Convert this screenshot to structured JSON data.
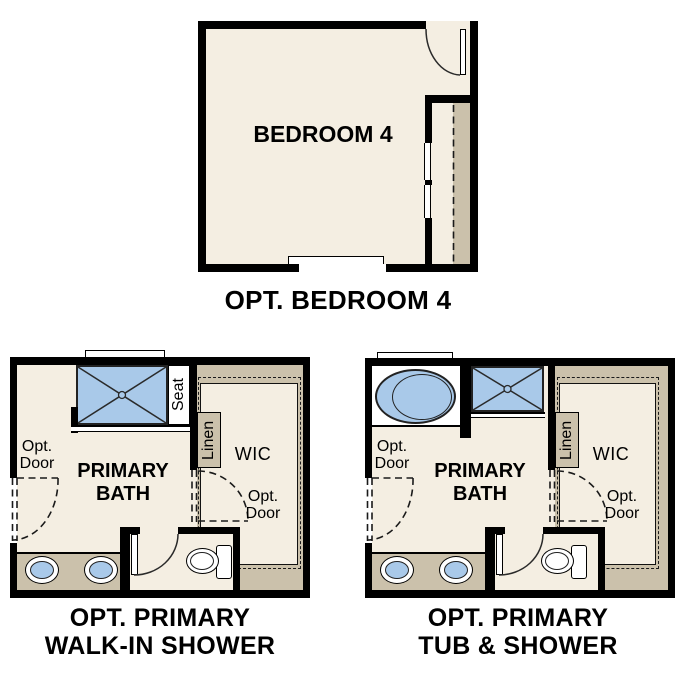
{
  "colors": {
    "wall": "#000000",
    "floor": "#f4eee2",
    "closet_tan": "#cbc1ab",
    "fixture_blue": "#a9c9e9",
    "background": "#ffffff"
  },
  "bedroom_plan": {
    "room_label": "BEDROOM 4",
    "caption": "OPT. BEDROOM 4"
  },
  "walk_in_shower_plan": {
    "room_label_line1": "PRIMARY",
    "room_label_line2": "BATH",
    "seat_label": "Seat",
    "linen_label": "Linen",
    "wic_label": "WIC",
    "opt_door_left_line1": "Opt.",
    "opt_door_left_line2": "Door",
    "opt_door_mid_line1": "Opt.",
    "opt_door_mid_line2": "Door",
    "caption_line1": "OPT. PRIMARY",
    "caption_line2": "WALK-IN SHOWER"
  },
  "tub_shower_plan": {
    "room_label_line1": "PRIMARY",
    "room_label_line2": "BATH",
    "seat_label": "Seat",
    "linen_label": "Linen",
    "wic_label": "WIC",
    "opt_door_left_line1": "Opt.",
    "opt_door_left_line2": "Door",
    "opt_door_mid_line1": "Opt.",
    "opt_door_mid_line2": "Door",
    "caption_line1": "OPT. PRIMARY",
    "caption_line2": "TUB & SHOWER"
  }
}
